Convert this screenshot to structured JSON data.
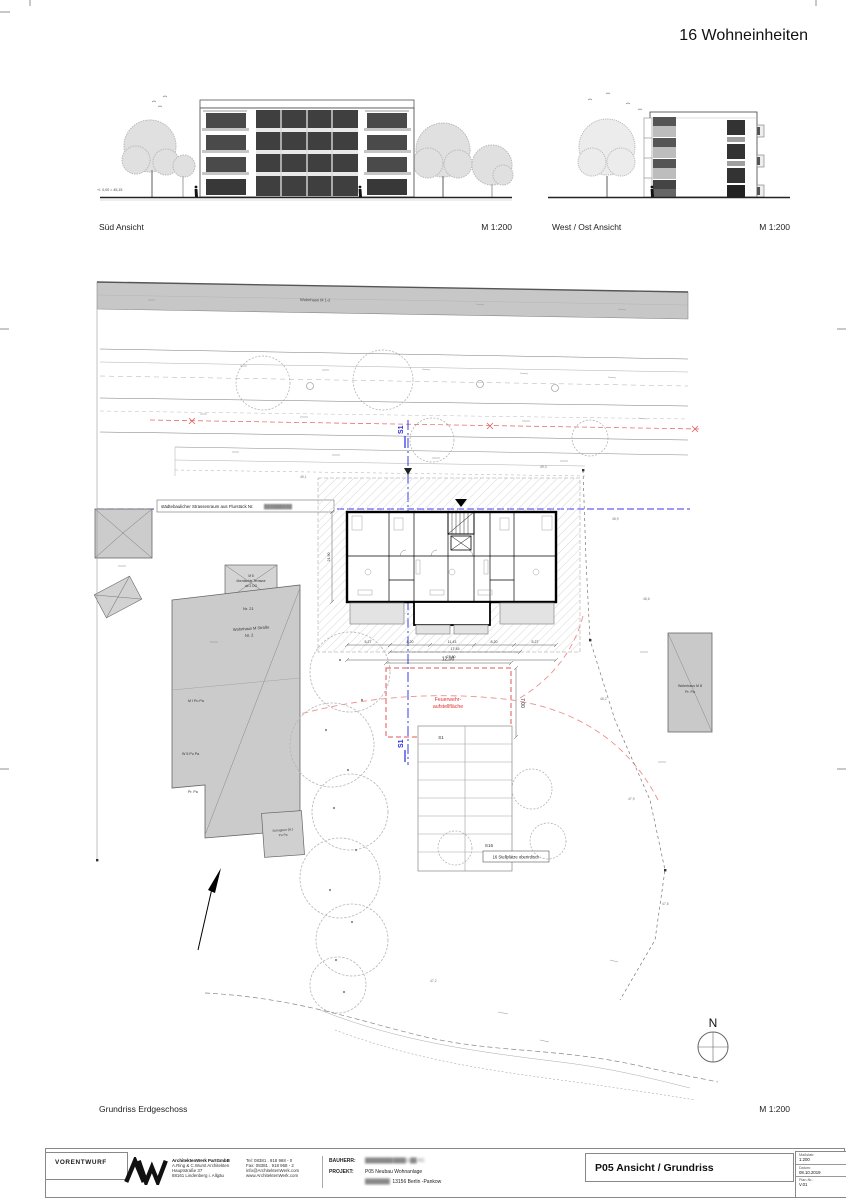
{
  "sheet": {
    "title": "16 Wohneinheiten"
  },
  "elevations": {
    "sued": {
      "label": "Süd Ansicht",
      "scale": "M 1:200",
      "level_note": "+/- 0,00 = 45,15"
    },
    "west_ost": {
      "label": "West / Ost Ansicht",
      "scale": "M 1:200"
    }
  },
  "site_plan": {
    "label": "Grundriss Erdgeschoss",
    "scale": "M 1:200",
    "street_band_label": "Wohnhaus M 1-2",
    "strassenraum_note": "städtebaulicher Strassenraum aus Flurstück Nr.",
    "strassenraum_note_redacted": "█████████",
    "section_line_label": "S1",
    "fire_lane": {
      "line1": "Feuerwehr-",
      "line2": "aufstellfläche",
      "width": "12,00",
      "depth": "7,00"
    },
    "parking": {
      "first_stall": "S1",
      "last_stall": "S16",
      "note": "16 Stellplätze oberirdisch"
    },
    "north_label": "N",
    "existing": {
      "house_no": "Nr. 21",
      "house_label_1": "Wohnhaus M Straße",
      "house_label_2": "Nr. 2",
      "terrace_1": "M 8",
      "terrace_2": "überdachte Terrasse",
      "terrace_3": "ab 2.OG",
      "note_1": "M I Pu Pa",
      "note_2": "W 5 Pu Pa",
      "note_3": "Pr. Pa",
      "shed_1": "Schuppen (H.)",
      "shed_2": "Pu Pa",
      "right_house_1": "Wohnhaus M 8",
      "right_house_2": "Pr. Pa"
    },
    "dims": {
      "row": [
        "5,27",
        "8,20",
        "11,43",
        "8,20",
        "5,27"
      ],
      "upper": "17,45",
      "total": "27,80",
      "left": "21,90"
    },
    "spot_heights": [
      "49,1",
      "49,3",
      "48,9",
      "48,6",
      "48,2",
      "47,9",
      "47,5",
      "47,2"
    ]
  },
  "title_block": {
    "status": "VORENTWURF",
    "firm": {
      "name": "ArchitektenWerk PartGmbB",
      "line2": "A.Ring & C.Wurst Architekten",
      "line3": "Hauptstraße 37",
      "line4": "88161 Lindenberg i. Allgäu",
      "tel": "Tel:  08381 . 918 968 - 0",
      "fax": "Fax:  08381 . 918 968 - 2",
      "email": "info@ArchitektenWerk.com",
      "web": "www.ArchitektenWerk.com"
    },
    "bauherr_label": "BAUHERR:",
    "bauherr_value_redacted": "█████████ ████ & ██. KG",
    "projekt_label": "PROJEKT:",
    "projekt_value": "P05 Neubau Wohnanlage",
    "projekt_addr_redacted": "████████",
    "projekt_addr": "13156 Berlin -Pankow",
    "plan_title": "P05 Ansicht / Grundriss",
    "massstab_label": "Maßstab:",
    "massstab_value": "1:200",
    "datum_label": "Datum:",
    "datum_value": "08.10.2019",
    "plannr_label": "Plan-Nr.:",
    "plannr_value": "V.01"
  }
}
